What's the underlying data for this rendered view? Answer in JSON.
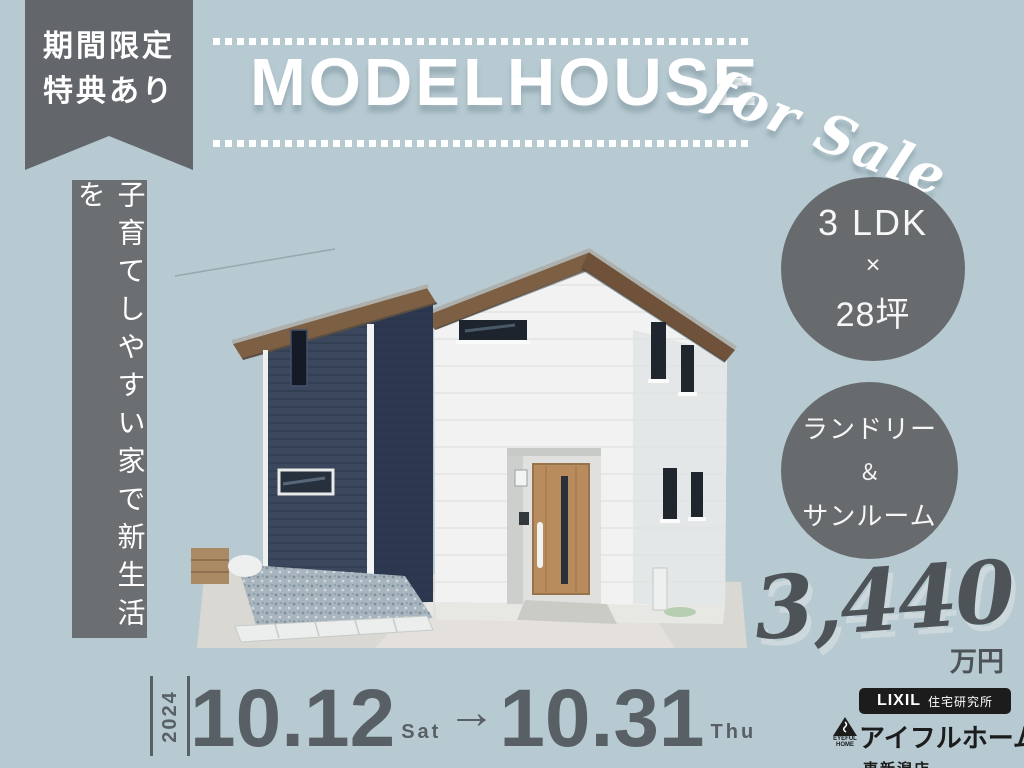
{
  "badge": {
    "line1": "期間限定",
    "line2": "特典あり"
  },
  "header": {
    "title": "MODELHOUSE",
    "script": "for Sale"
  },
  "left_banner": {
    "text": "子育てしやすい家で新生活を"
  },
  "features": [
    {
      "lines": [
        "3 LDK",
        "×",
        "28坪"
      ]
    },
    {
      "lines": [
        "ランドリー",
        "＆",
        "サンルーム"
      ]
    }
  ],
  "price": {
    "amount": "3,440",
    "unit": "万円"
  },
  "schedule": {
    "year": "2024",
    "start_date": "10.12",
    "start_day": "Sat",
    "arrow": "→",
    "end_date": "10.31",
    "end_day": "Thu"
  },
  "logo": {
    "brand": "LIXIL",
    "division": "住宅研究所",
    "name": "アイフルホーム",
    "store": "東新潟店",
    "icon_text_1": "EYEFUL",
    "icon_text_2": "HOME"
  },
  "colors": {
    "background": "#b7cad2",
    "panel_gray": "#676b6e",
    "text_white": "#ffffff",
    "date_gray": "#586065",
    "price_gray": "#4d5357",
    "house_navy": "#3a475c",
    "roof_brown": "#7d5f44"
  }
}
